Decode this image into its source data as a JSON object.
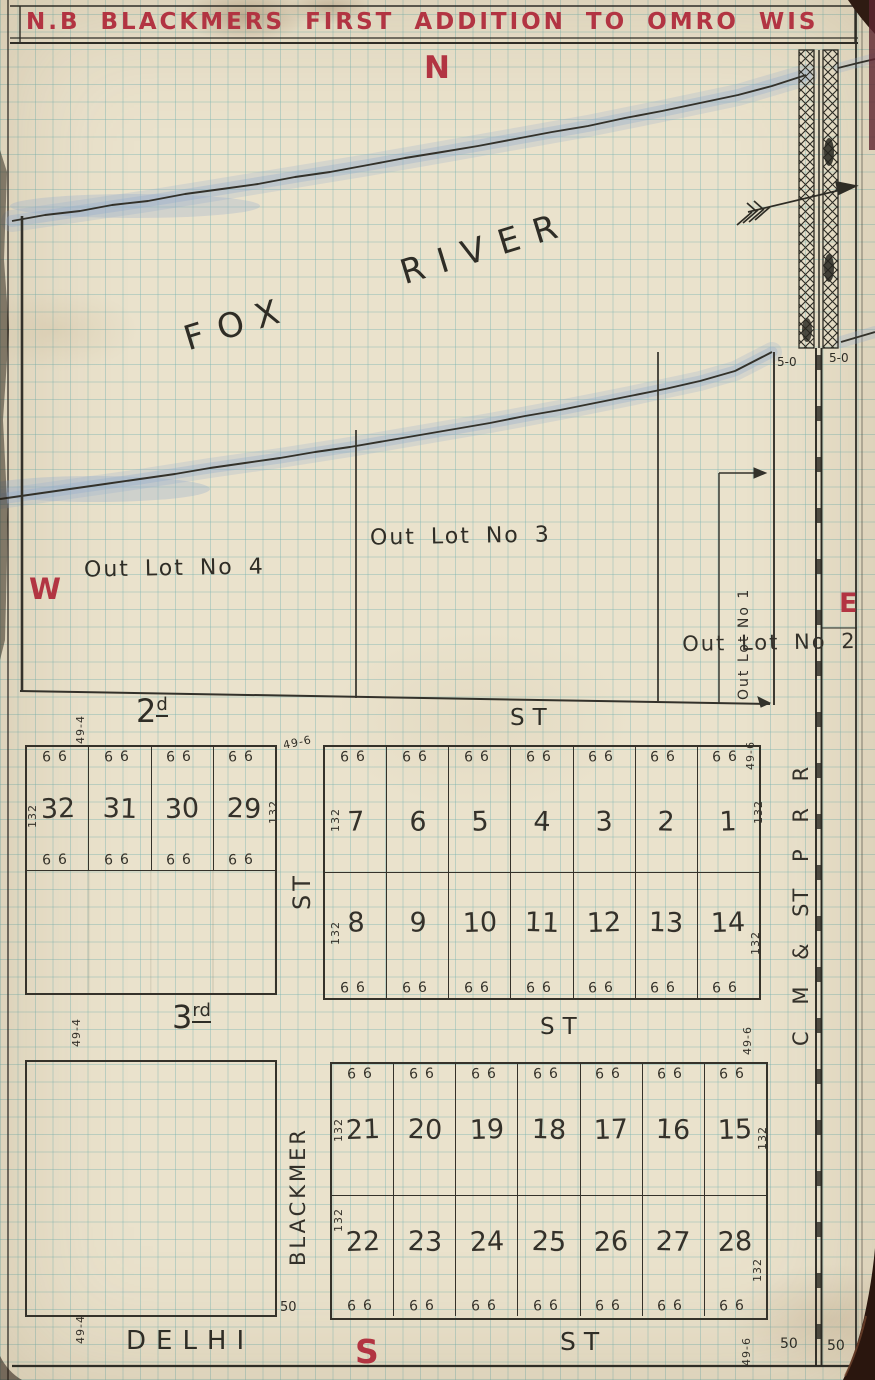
{
  "title": "N.B BLACKMERS FIRST ADDITION TO OMRO WIS",
  "compass": {
    "n": "N",
    "w": "W",
    "e": "E",
    "s": "S"
  },
  "river_label": "FOX RIVER",
  "railroad_label": "C M & ST P R R",
  "out_lots": {
    "no4": "Out Lot No 4",
    "no3": "Out Lot No 3",
    "no2": "Out Lot No 2",
    "no1": "Out Lot No 1"
  },
  "streets": {
    "second": {
      "num": "2",
      "sup": "d",
      "type": "ST"
    },
    "third": {
      "num": "3",
      "sup": "rd",
      "type": "ST"
    },
    "delhi": {
      "name": "DELHI",
      "type": "ST"
    },
    "blackmer": {
      "name": "BLACKMER",
      "type": "ST"
    }
  },
  "blocks": {
    "west_row": [
      "32",
      "31",
      "30",
      "29"
    ],
    "east_upper_row1": [
      "7",
      "6",
      "5",
      "4",
      "3",
      "2",
      "1"
    ],
    "east_upper_row2": [
      "8",
      "9",
      "10",
      "11",
      "12",
      "13",
      "14"
    ],
    "east_lower_row1": [
      "21",
      "20",
      "19",
      "18",
      "17",
      "16",
      "15"
    ],
    "east_lower_row2": [
      "22",
      "23",
      "24",
      "25",
      "26",
      "27",
      "28"
    ]
  },
  "dims": {
    "front": "66",
    "depth": "132",
    "w494": "49-4",
    "w496": "49-6",
    "fifty": "50",
    "bridge_fifty": "5-0"
  },
  "colors": {
    "title_red": "#b23442",
    "ink": "#35322a",
    "paper": "#eae2cc",
    "grid_teal": "#76b2b0",
    "river_blue": "#8fa8cc"
  }
}
